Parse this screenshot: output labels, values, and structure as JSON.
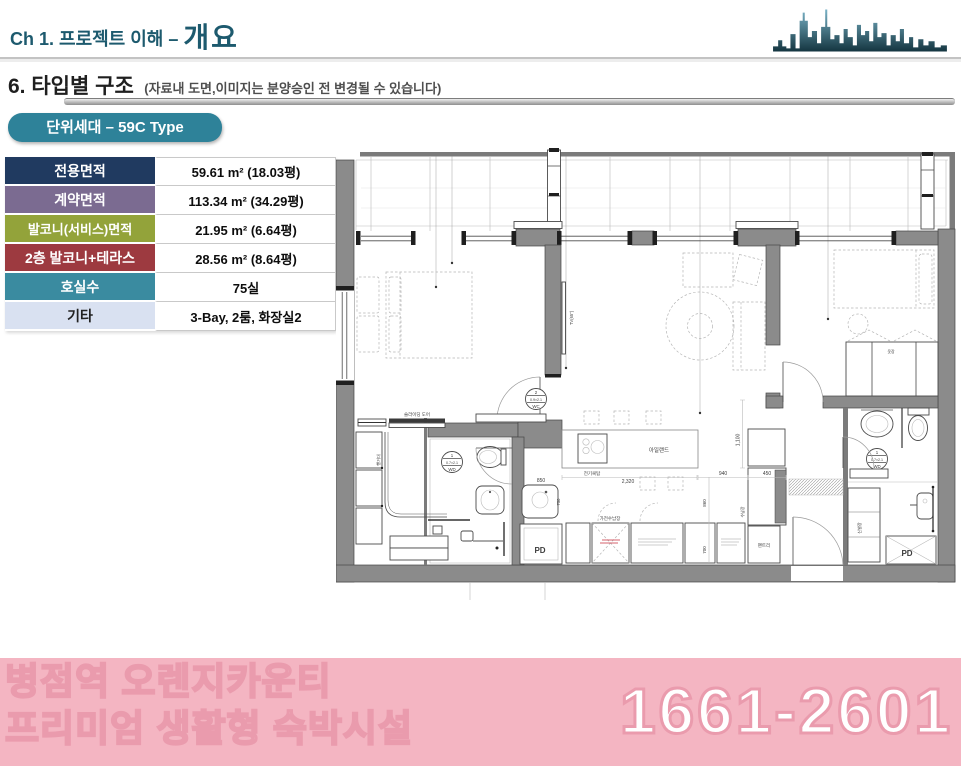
{
  "header": {
    "chapter": "Ch 1. 프로젝트 이해 –",
    "chapter_emph": "개요",
    "title_color": "#1d5a6e"
  },
  "section": {
    "title": "6. 타입별 구조",
    "note": "(자료내 도면,이미지는 분양승인 전 변경될 수 있습니다)"
  },
  "unit_badge": {
    "label": "단위세대 – 59C Type",
    "bg": "#2e8299"
  },
  "spec_table": {
    "rows": [
      {
        "label": "전용면적",
        "value": "59.61 m²  (18.03평)",
        "color": "#203a60"
      },
      {
        "label": "계약면적",
        "value": "113.34 m² (34.29평)",
        "color": "#7b6b91"
      },
      {
        "label": "발코니(서비스)면적",
        "value": "21.95 m²  (6.64평)",
        "color": "#93a33a"
      },
      {
        "label": "2층 발코니+테라스",
        "value": "28.56 m²  (8.64평)",
        "color": "#9d3a40"
      },
      {
        "label": "호실수",
        "value": "75실",
        "color": "#3a8ba0"
      },
      {
        "label": "기타",
        "value": "3-Bay, 2룸, 화장실2",
        "color": "#d9e1f1"
      }
    ]
  },
  "floor_plan": {
    "labels": {
      "sliding_door": "슬라이딩 도어",
      "hanger": "행거대",
      "tv": "TV(65\")",
      "island": "아일랜드",
      "cooktop": "전기쿡탑",
      "appliance_cabinet": "가전수납장",
      "pantry": "팬트리",
      "storage": "수납장",
      "shoe_cabinet": "신발장",
      "wardrobe": "옷장",
      "pd": "PD"
    },
    "door_tags": {
      "wd": {
        "no": "1",
        "size": "0.7×2.1",
        "type": "WD"
      },
      "wc": {
        "no": "2",
        "size": "0.9×2.1",
        "type": "WC"
      }
    },
    "dims": {
      "d850": "850",
      "d2320": "2,320",
      "d940": "940",
      "d450": "450",
      "d1100": "1,100",
      "d700": "700",
      "d860": "860",
      "d750": "750"
    }
  },
  "footer": {
    "line1": "병점역 오렌지카운티",
    "line2": "프리미엄 생활형 숙박시설",
    "phone": "1661-2601",
    "bg": "#f4b5c2",
    "outline": "#ea9bad"
  }
}
